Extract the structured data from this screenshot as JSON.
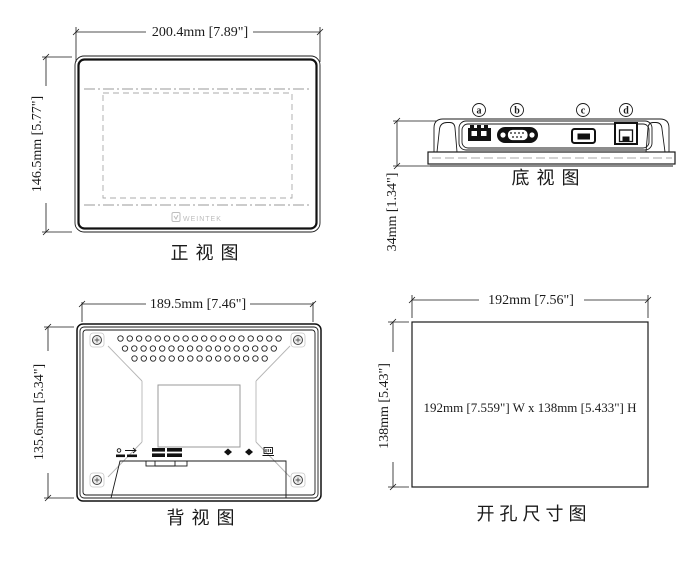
{
  "drawing": {
    "views": {
      "front": {
        "title": "正视图",
        "width_label": "200.4mm [7.89\"]",
        "height_label": "146.5mm [5.77\"]",
        "logo_text": "WEINTEK"
      },
      "bottom": {
        "title": "底视图",
        "height_label": "34mm [1.34\"]",
        "ports": [
          {
            "label": "a",
            "name": "power-terminal-port"
          },
          {
            "label": "b",
            "name": "serial-db9-port"
          },
          {
            "label": "c",
            "name": "usb-port"
          },
          {
            "label": "d",
            "name": "ethernet-port"
          }
        ]
      },
      "rear": {
        "title": "背视图",
        "width_label": "189.5mm [7.46\"]",
        "height_label": "135.6mm [5.34\"]"
      },
      "cutout": {
        "title": "开孔尺寸图",
        "width_label": "192mm [7.56\"]",
        "height_label": "138mm [5.43\"]",
        "center_label": "192mm [7.559\"] W x 138mm [5.433\"] H"
      }
    },
    "colors": {
      "line": "#1a1a1a",
      "faint_gray": "#b5b5b5",
      "logo_gray": "#bdbdbd",
      "background": "#ffffff"
    }
  }
}
